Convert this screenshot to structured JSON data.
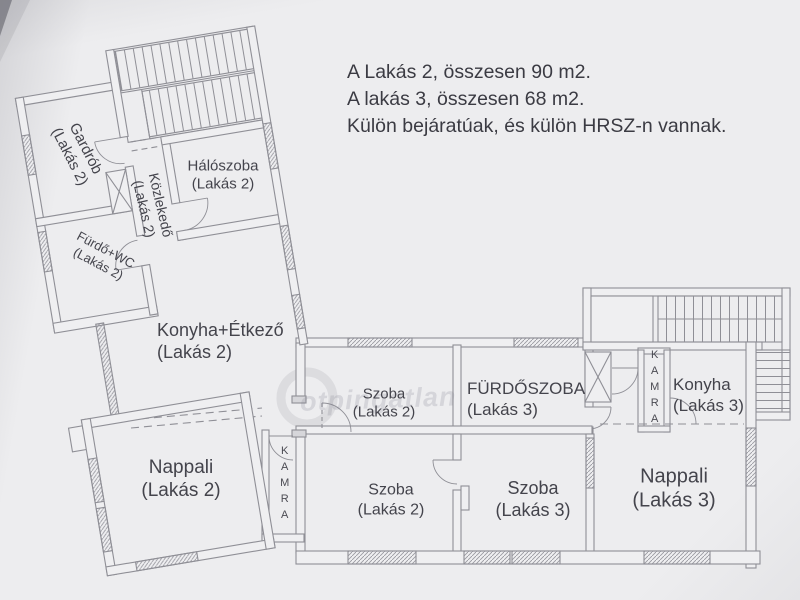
{
  "page": {
    "background": "#ededef",
    "line_color": "#8f8f96",
    "text_color": "#44444c"
  },
  "note": {
    "line1": "A Lakás 2, összesen 90 m2.",
    "line2": "A lakás 3, összesen 68 m2.",
    "line3": "Külön bejáratúak, és külön HRSZ-n vannak."
  },
  "watermark": {
    "text": "otpingatlan"
  },
  "rooms": {
    "gardrob": {
      "name": "Gardrób",
      "unit": "(Lakás 2)"
    },
    "haloszoba": {
      "name": "Hálószoba",
      "unit": "(Lakás 2)"
    },
    "kozlekedo": {
      "name": "Közlekedő",
      "unit": "(Lakás 2)"
    },
    "furdo_wc": {
      "name": "Fürdő+WC",
      "unit": "(Lakás 2)"
    },
    "konyha_etkezo": {
      "name": "Konyha+Étkező",
      "unit": "(Lakás 2)"
    },
    "nappali_l2": {
      "name": "Nappali",
      "unit": "(Lakás 2)"
    },
    "kamra_l2": {
      "name": "KAMRA"
    },
    "szoba_l2_felso": {
      "name": "Szoba",
      "unit": "(Lakás 2)"
    },
    "szoba_l2_also": {
      "name": "Szoba",
      "unit": "(Lakás 2)"
    },
    "furdoszoba_l3": {
      "name": "FÜRDŐSZOBA",
      "unit": "(Lakás 3)"
    },
    "szoba_l3": {
      "name": "Szoba",
      "unit": "(Lakás 3)"
    },
    "konyha_l3": {
      "name": "Konyha",
      "unit": "(Lakás 3)"
    },
    "kamra_l3": {
      "name": "KAMRA"
    },
    "nappali_l3": {
      "name": "Nappali",
      "unit": "(Lakás 3)"
    }
  }
}
